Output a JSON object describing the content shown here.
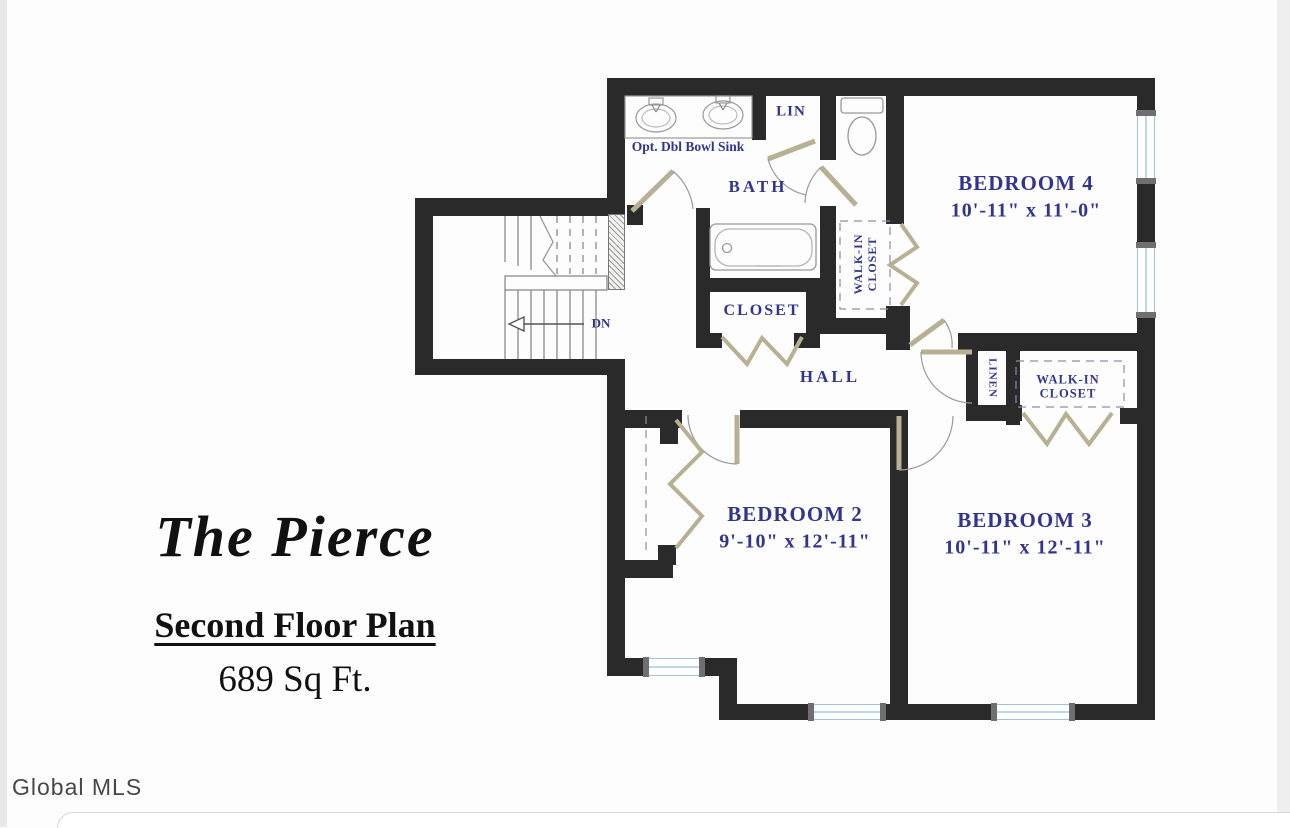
{
  "title_block": {
    "plan_name": "The Pierce",
    "subtitle": "Second Floor Plan",
    "area": "689 Sq Ft."
  },
  "watermark": {
    "label": "Global MLS"
  },
  "rooms": {
    "bedroom4": {
      "name": "BEDROOM 4",
      "dims": "10'-11\" x 11'-0\""
    },
    "bedroom2": {
      "name": "BEDROOM 2",
      "dims": "9'-10\" x 12'-11\""
    },
    "bedroom3": {
      "name": "BEDROOM 3",
      "dims": "10'-11\" x 12'-11\""
    },
    "bath": {
      "name": "BATH"
    },
    "hall": {
      "name": "HALL"
    },
    "hall_closet": {
      "name": "CLOSET"
    },
    "linen_cabinet": {
      "name": "LIN"
    },
    "linen_closet": {
      "name": "LINEN"
    },
    "walkin_closet_bed4": {
      "line1": "WALK-IN",
      "line2": "CLOSET"
    },
    "walkin_closet_bed3": {
      "line1": "WALK-IN",
      "line2": "CLOSET"
    }
  },
  "annotations": {
    "sink_note": "Opt. Dbl Bowl Sink",
    "stair_direction": "DN"
  },
  "colors": {
    "wall": "#2a2a2a",
    "room_label": "#32358e",
    "window_glass": "#ffffff",
    "window_frame": "#9fc4d8",
    "door_leaf": "#b7b093",
    "title_text": "#111111",
    "watermark_text": "#474747"
  }
}
